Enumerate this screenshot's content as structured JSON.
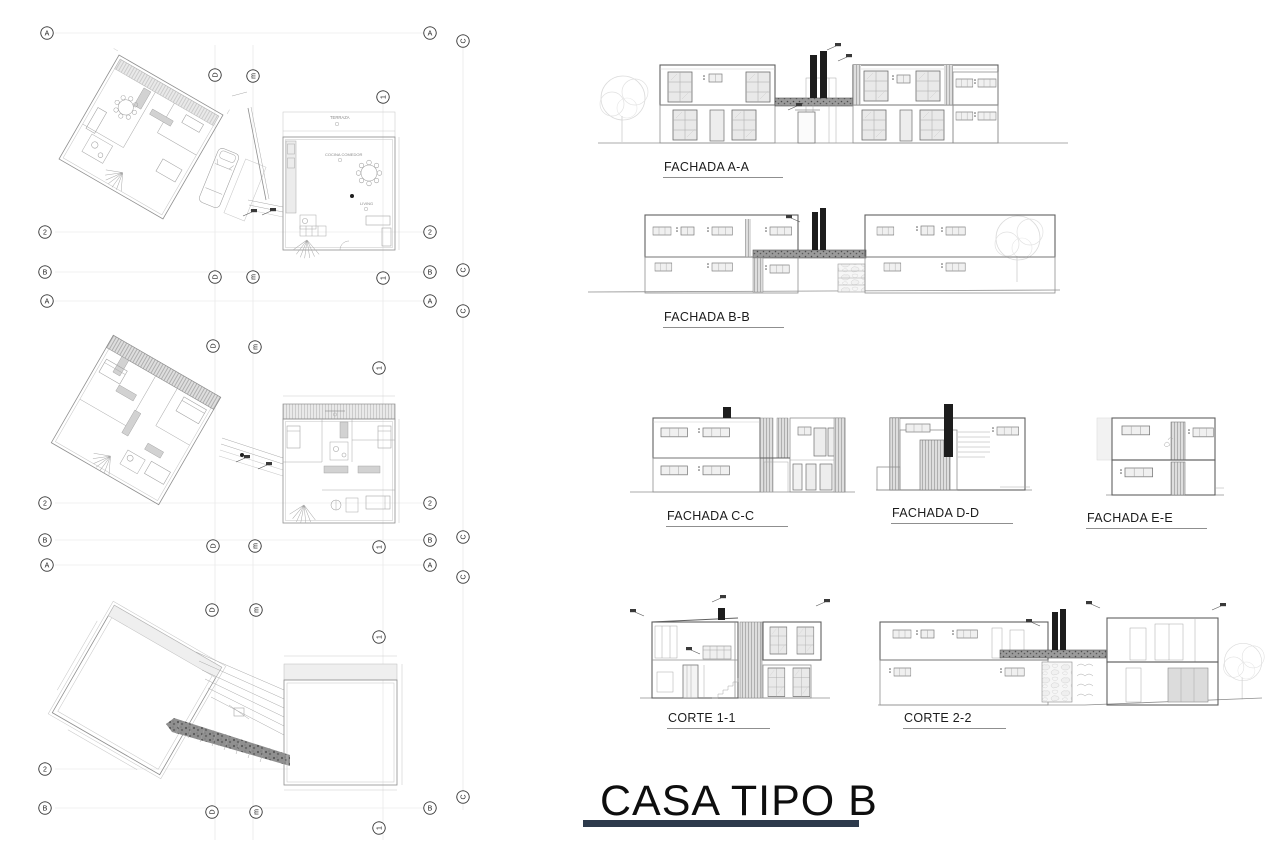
{
  "sheet": {
    "title": "CASA TIPO B"
  },
  "colors": {
    "accent_bar": "#2d3a4c",
    "drawing_line": "#8f8f8f",
    "dark_fill": "#1d1d1d",
    "stone_fill": "#f4f4f4",
    "hatch_gray": "#d2d2d2"
  },
  "drawings": {
    "fachada_aa": {
      "label": "FACHADA A-A"
    },
    "fachada_bb": {
      "label": "FACHADA B-B"
    },
    "fachada_cc": {
      "label": "FACHADA C-C"
    },
    "fachada_dd": {
      "label": "FACHADA D-D"
    },
    "fachada_ee": {
      "label": "FACHADA E-E"
    },
    "corte_11": {
      "label": "CORTE 1-1"
    },
    "corte_22": {
      "label": "CORTE 2-2"
    }
  },
  "plan_labels": {
    "terraza": "TERRAZA",
    "cocina_comedor": "COCINA COMEDOR",
    "living": "LIVING"
  },
  "grid_markers": [
    {
      "t": "A",
      "x": 47,
      "y": 33,
      "v": false
    },
    {
      "t": "A",
      "x": 430,
      "y": 33,
      "v": false
    },
    {
      "t": "C",
      "x": 463,
      "y": 41,
      "v": true
    },
    {
      "t": "D",
      "x": 215,
      "y": 75,
      "v": true
    },
    {
      "t": "m",
      "x": 253,
      "y": 76,
      "v": true
    },
    {
      "t": "1",
      "x": 383,
      "y": 97,
      "v": true
    },
    {
      "t": "2",
      "x": 45,
      "y": 232,
      "v": false
    },
    {
      "t": "2",
      "x": 430,
      "y": 232,
      "v": false
    },
    {
      "t": "B",
      "x": 45,
      "y": 272,
      "v": false
    },
    {
      "t": "B",
      "x": 430,
      "y": 272,
      "v": false
    },
    {
      "t": "C",
      "x": 463,
      "y": 270,
      "v": true
    },
    {
      "t": "D",
      "x": 215,
      "y": 277,
      "v": true
    },
    {
      "t": "m",
      "x": 253,
      "y": 277,
      "v": true
    },
    {
      "t": "1",
      "x": 383,
      "y": 278,
      "v": true
    },
    {
      "t": "A",
      "x": 47,
      "y": 301,
      "v": false
    },
    {
      "t": "A",
      "x": 430,
      "y": 301,
      "v": false
    },
    {
      "t": "C",
      "x": 463,
      "y": 311,
      "v": true
    },
    {
      "t": "D",
      "x": 213,
      "y": 346,
      "v": true
    },
    {
      "t": "m",
      "x": 255,
      "y": 347,
      "v": true
    },
    {
      "t": "1",
      "x": 379,
      "y": 368,
      "v": true
    },
    {
      "t": "2",
      "x": 45,
      "y": 503,
      "v": false
    },
    {
      "t": "2",
      "x": 430,
      "y": 503,
      "v": false
    },
    {
      "t": "B",
      "x": 45,
      "y": 540,
      "v": false
    },
    {
      "t": "B",
      "x": 430,
      "y": 540,
      "v": false
    },
    {
      "t": "C",
      "x": 463,
      "y": 537,
      "v": true
    },
    {
      "t": "D",
      "x": 213,
      "y": 546,
      "v": true
    },
    {
      "t": "m",
      "x": 255,
      "y": 546,
      "v": true
    },
    {
      "t": "1",
      "x": 379,
      "y": 547,
      "v": true
    },
    {
      "t": "A",
      "x": 47,
      "y": 565,
      "v": false
    },
    {
      "t": "A",
      "x": 430,
      "y": 565,
      "v": false
    },
    {
      "t": "C",
      "x": 463,
      "y": 577,
      "v": true
    },
    {
      "t": "D",
      "x": 212,
      "y": 610,
      "v": true
    },
    {
      "t": "m",
      "x": 256,
      "y": 610,
      "v": true
    },
    {
      "t": "1",
      "x": 379,
      "y": 637,
      "v": true
    },
    {
      "t": "2",
      "x": 45,
      "y": 769,
      "v": false
    },
    {
      "t": "B",
      "x": 45,
      "y": 808,
      "v": false
    },
    {
      "t": "B",
      "x": 430,
      "y": 808,
      "v": false
    },
    {
      "t": "C",
      "x": 463,
      "y": 797,
      "v": true
    },
    {
      "t": "D",
      "x": 212,
      "y": 812,
      "v": true
    },
    {
      "t": "m",
      "x": 256,
      "y": 812,
      "v": true
    },
    {
      "t": "1",
      "x": 379,
      "y": 828,
      "v": true
    }
  ]
}
